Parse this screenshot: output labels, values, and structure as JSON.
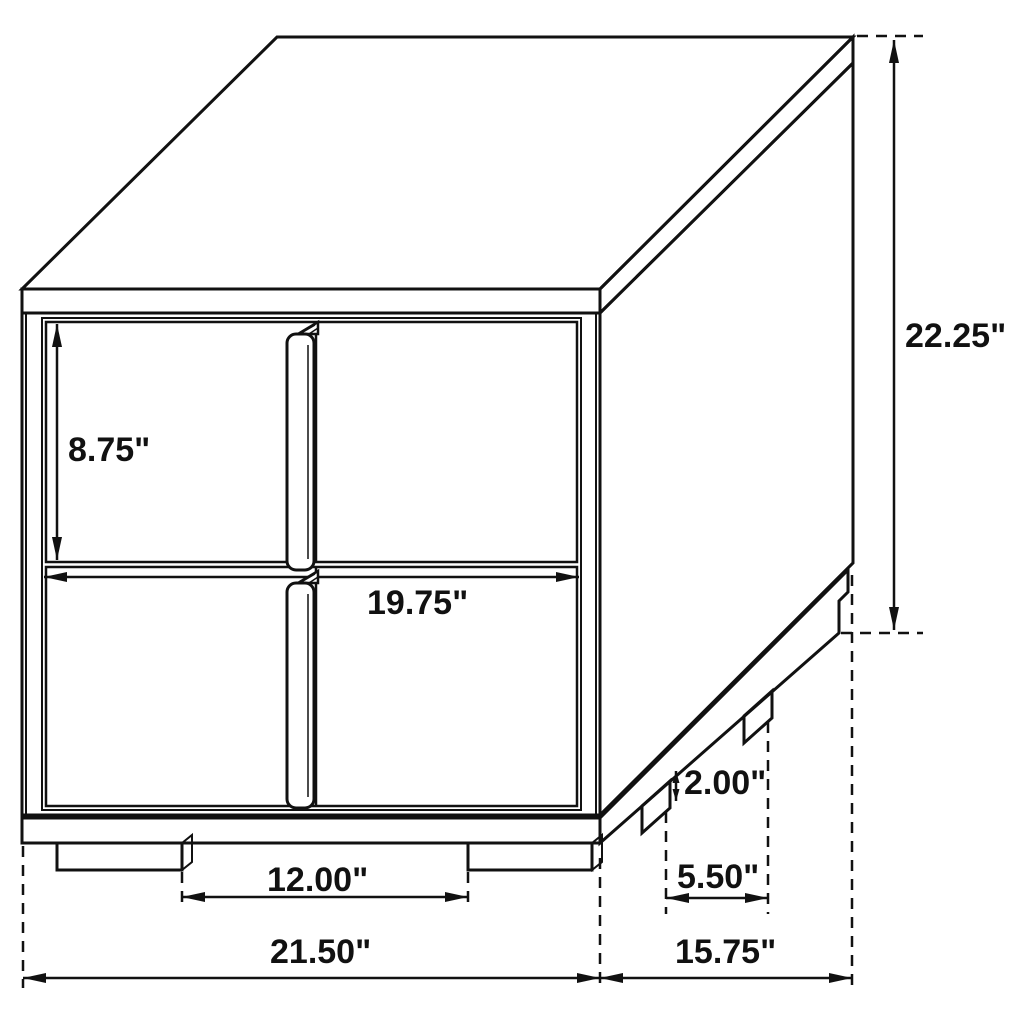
{
  "diagram": {
    "background_color": "#ffffff",
    "line_color": "#111111",
    "units": "inches",
    "dimensions": {
      "drawer_front_height": {
        "label": "8.75\"",
        "value": 8.75
      },
      "drawer_front_width": {
        "label": "19.75\"",
        "value": 19.75
      },
      "overall_height": {
        "label": "22.25\"",
        "value": 22.25
      },
      "foot_height": {
        "label": "2.00\"",
        "value": 2.0
      },
      "side_foot_spacing": {
        "label": "5.50\"",
        "value": 5.5
      },
      "front_foot_spacing": {
        "label": "12.00\"",
        "value": 12.0
      },
      "overall_width": {
        "label": "21.50\"",
        "value": 21.5
      },
      "overall_depth": {
        "label": "15.75\"",
        "value": 15.75
      }
    }
  }
}
